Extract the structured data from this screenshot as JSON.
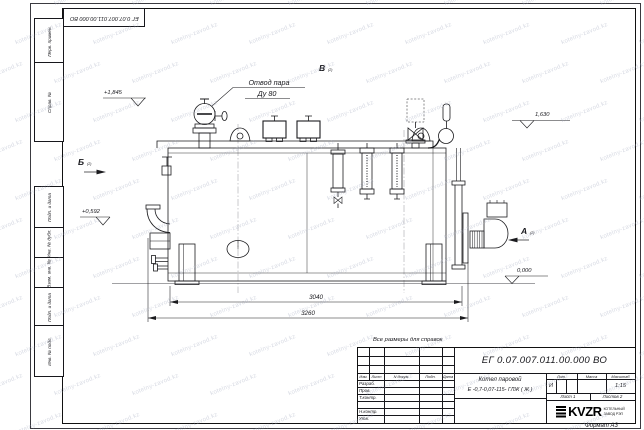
{
  "sheet": {
    "stamp_number": "ЕГ 0.07.007.011.00.000 ВО",
    "format_label": "Формат А3",
    "reference_note": "Все размеры для справок",
    "watermark": "kotelny-zavod.kz"
  },
  "margin_labels": [
    "Перв. примен.",
    "Справ. №",
    "Подп. и дата",
    "Инв. № дубл.",
    "Взам. инв. №",
    "Подп. и дата",
    "Инв. № подл."
  ],
  "drawing": {
    "callout_line1": "Отвод пара",
    "callout_line2": "Ду 80",
    "view_a": "А",
    "view_b": "Б",
    "view_v": "В",
    "view_ref": "(2)",
    "elevation_top": "+1,845",
    "elevation_right": "1,630",
    "elevation_left": "+0,592",
    "elevation_zero": "0,000",
    "dim_inner": "3040",
    "dim_outer": "3260"
  },
  "titleblock": {
    "doc_number": "ЕГ 0.07.007.011.00.000  ВО",
    "title_line1": "Котел паровой",
    "title_line2": "Е -0,7-0,07-115- ГЛЖ ( Ж )",
    "header_cols": [
      "Изм.",
      "Лист",
      "N докум.",
      "Подп.",
      "Дата"
    ],
    "rows": [
      "Разраб.",
      "Пров.",
      "Т.контр.",
      "",
      "Н.контр.",
      "Утв."
    ],
    "lit_label": "Лит.",
    "mass_label": "Масса",
    "scale_label": "Масштаб",
    "lit_value": "И",
    "scale_value": "1:15",
    "sheet_label": "Лист 1",
    "sheets_label": "Листов 2",
    "company_logo": "KVZR",
    "company_name1": "КОТЕЛЬНЫЙ",
    "company_name2": "ЗАВОД РЭП"
  }
}
